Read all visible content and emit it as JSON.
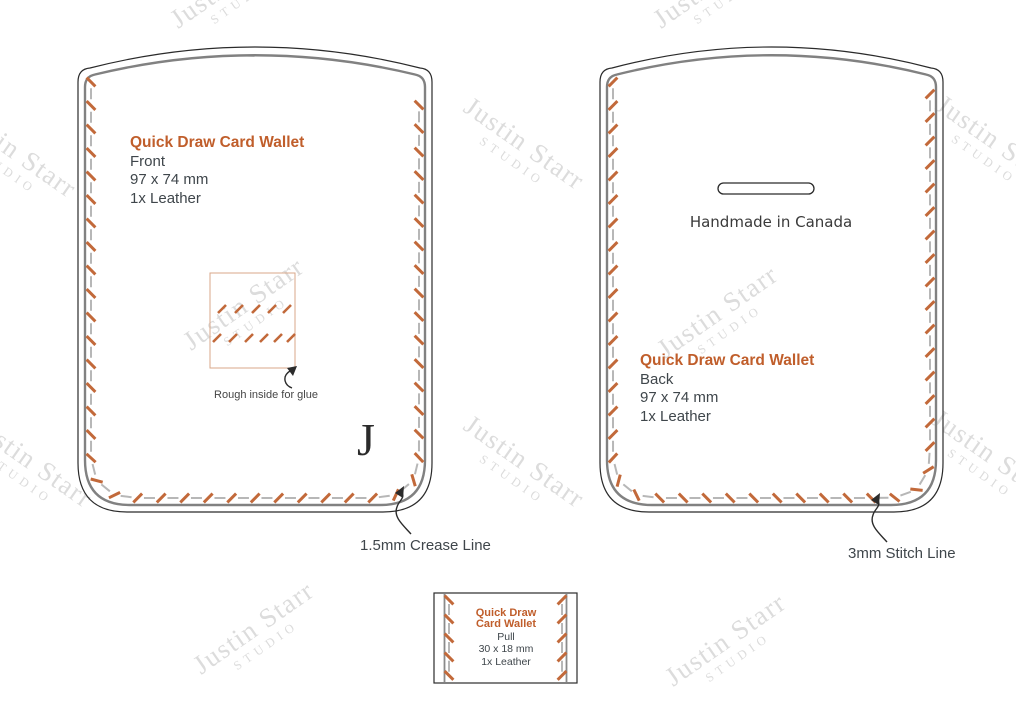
{
  "watermark": {
    "name": "Justin Starr",
    "studio": "STUDIO"
  },
  "front_piece": {
    "title": "Quick Draw Card Wallet",
    "part": "Front",
    "size": "97 x 74 mm",
    "material": "1x Leather",
    "glue_note": "Rough inside for glue",
    "makers_mark": "J"
  },
  "back_piece": {
    "title": "Quick Draw Card Wallet",
    "part": "Back",
    "size": "97 x 74 mm",
    "material": "1x Leather",
    "stamp": "Handmade in Canada"
  },
  "pull_piece": {
    "title_line1": "Quick Draw",
    "title_line2": "Card Wallet",
    "part": "Pull",
    "size": "30 x 18 mm",
    "material": "1x Leather"
  },
  "annotations": {
    "crease_label": "1.5mm Crease Line",
    "stitch_label": "3mm Stitch Line"
  },
  "colors": {
    "accent_orange": "#C05E2B",
    "stitch_orange": "#C2693A",
    "text_dark": "#3F464B",
    "cut_line": "#2B2B2B",
    "crease_line": "#818181",
    "stitch_connector": "#B7B7B7",
    "glue_border": "#D8A78A",
    "watermark_gray": "#DCDCDC"
  }
}
